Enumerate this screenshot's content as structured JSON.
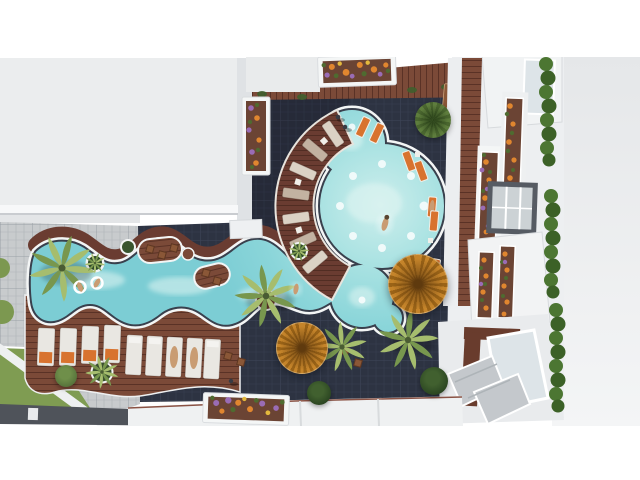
{
  "meta": {
    "type": "architectural-render",
    "view": "top-down aerial",
    "subject": "resort courtyard with free-form swimming pool",
    "alt": "Aerial top-down 3D rendering of an apartment-complex courtyard: an octopus-shaped turquoise pool with white coping connects to a winding lazy-river arm, surrounded by dark tiled paving, a curved maroon timber deck with radial sun loungers, two thatched umbrellas, palm trees, flower planters, rows of white loungers with orange towels, a grass patch, and a white residential building with flower-box balconies and hedges on the east side.",
    "canvas": {
      "width": 640,
      "height": 480
    }
  },
  "palette": {
    "bg": "#ffffff",
    "roof": "#ebedee",
    "roof-right": "#e7e9eb",
    "wall": "#dfe2e5",
    "tile-dark": "#2d3342",
    "tile-line": "#3c4356",
    "tile-light": "#c8cbcd",
    "wood": "#7b4a38",
    "wood-line": "#5a3226",
    "deck": "#6a3c31",
    "deck-line": "#4e2b21",
    "coping": "#f3f5f5",
    "rim": "#39404d",
    "water": "#8ad5d9",
    "water-light": "#d8f2f0",
    "lounger-a": "#dbd2c5",
    "lounger-b": "#c2b2a1",
    "lounger-w": "#e9e7e2",
    "towel": "#d8732f",
    "umbrella-a": "#c5842a",
    "umbrella-b": "#9a6317",
    "palm-light": "#a6bd6e",
    "palm-dark": "#78974e",
    "tree-a": "#5e7d3d",
    "tree-b": "#4a662f",
    "bush": "#2f4c26",
    "hedge-a": "#4c7632",
    "hedge-b": "#3c6127",
    "grass": "#7f9c52",
    "flower-orange": "#e0862f",
    "flower-purple": "#9a6cb5",
    "flower-yellow": "#e3b93d",
    "leaf": "#4f6b30",
    "soil": "#6b4434",
    "glass": "#dde4e8",
    "frame": "#565b63",
    "stone": "#c4c8cc",
    "skin": "#c99c73",
    "people-dark": "#383b44"
  },
  "scene": {
    "regions": [
      {
        "name": "sky-band-north",
        "desc": "white band across the top"
      },
      {
        "name": "apartment-roof-west",
        "desc": "large flat white roof, upper left"
      },
      {
        "name": "courtyard",
        "desc": "dark navy tiled pool courtyard"
      },
      {
        "name": "patio-west",
        "desc": "light grey paver patio"
      },
      {
        "name": "grass-southwest",
        "desc": "lawn patch with diagonal white path"
      },
      {
        "name": "facade-east",
        "desc": "white balconies with flower boxes, windows, hedges and stairs"
      },
      {
        "name": "roofline-south",
        "desc": "white roof strip with planter"
      }
    ],
    "objects": [
      {
        "name": "free-form-pool",
        "desc": "octopus-shaped main pool joined to a winding lazy-river arm, white coping and dark rim"
      },
      {
        "name": "lounger-deck-arc",
        "desc": "curved maroon timber deck west of the main pool with 7 radial loungers"
      },
      {
        "name": "thatched-umbrella",
        "count": 2
      },
      {
        "name": "orange-sun-lounger",
        "count": 8
      },
      {
        "name": "south-lounger-row",
        "count": 9
      },
      {
        "name": "palm-tree",
        "count": 7
      },
      {
        "name": "round-tree-or-bush",
        "count": 5
      },
      {
        "name": "flower-planter",
        "count": 7
      },
      {
        "name": "hedge-strip",
        "count": 3
      },
      {
        "name": "swimmer",
        "count": 4
      },
      {
        "name": "stool-seat",
        "count": 9
      }
    ]
  }
}
